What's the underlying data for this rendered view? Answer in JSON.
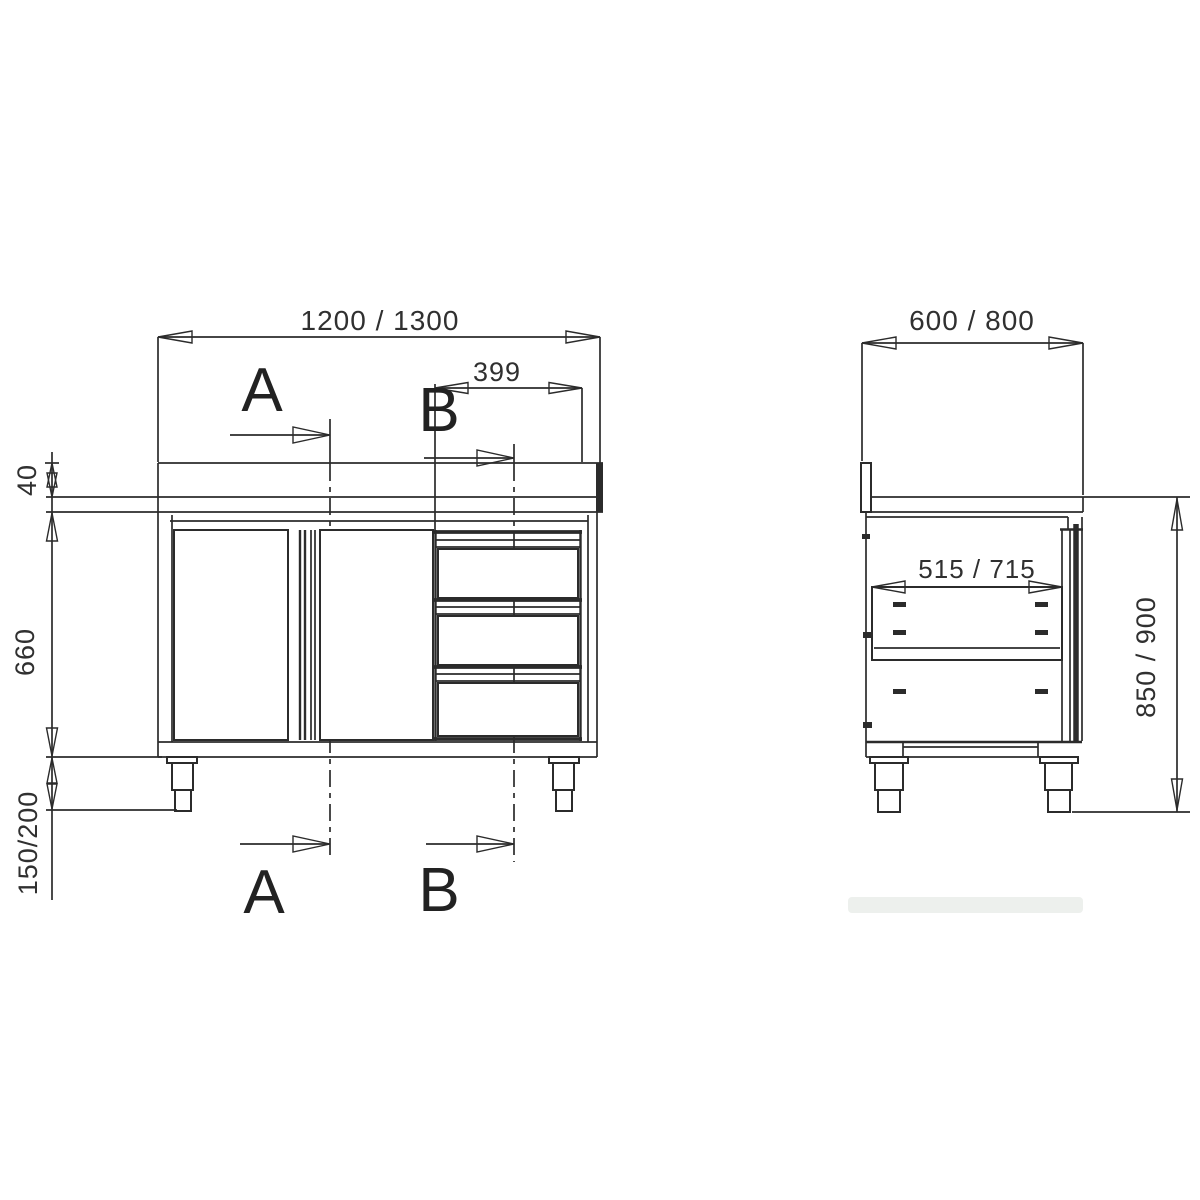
{
  "drawing_title": "stainless work cabinet with sliding doors and drawers - dimensioned drawing",
  "front_view": {
    "overall_width": "1200 / 1300",
    "drawer_block_width": "399",
    "upstand_height": "40",
    "body_height": "660",
    "leg_height": "150/200",
    "section_a_label": "A",
    "section_b_label": "B"
  },
  "side_view": {
    "overall_depth": "600 / 800",
    "drawer_inner_depth": "515 / 715",
    "working_height": "850 / 900"
  },
  "colors": {
    "line": "#2b2b2b",
    "text": "#303030",
    "background": "#ffffff"
  }
}
